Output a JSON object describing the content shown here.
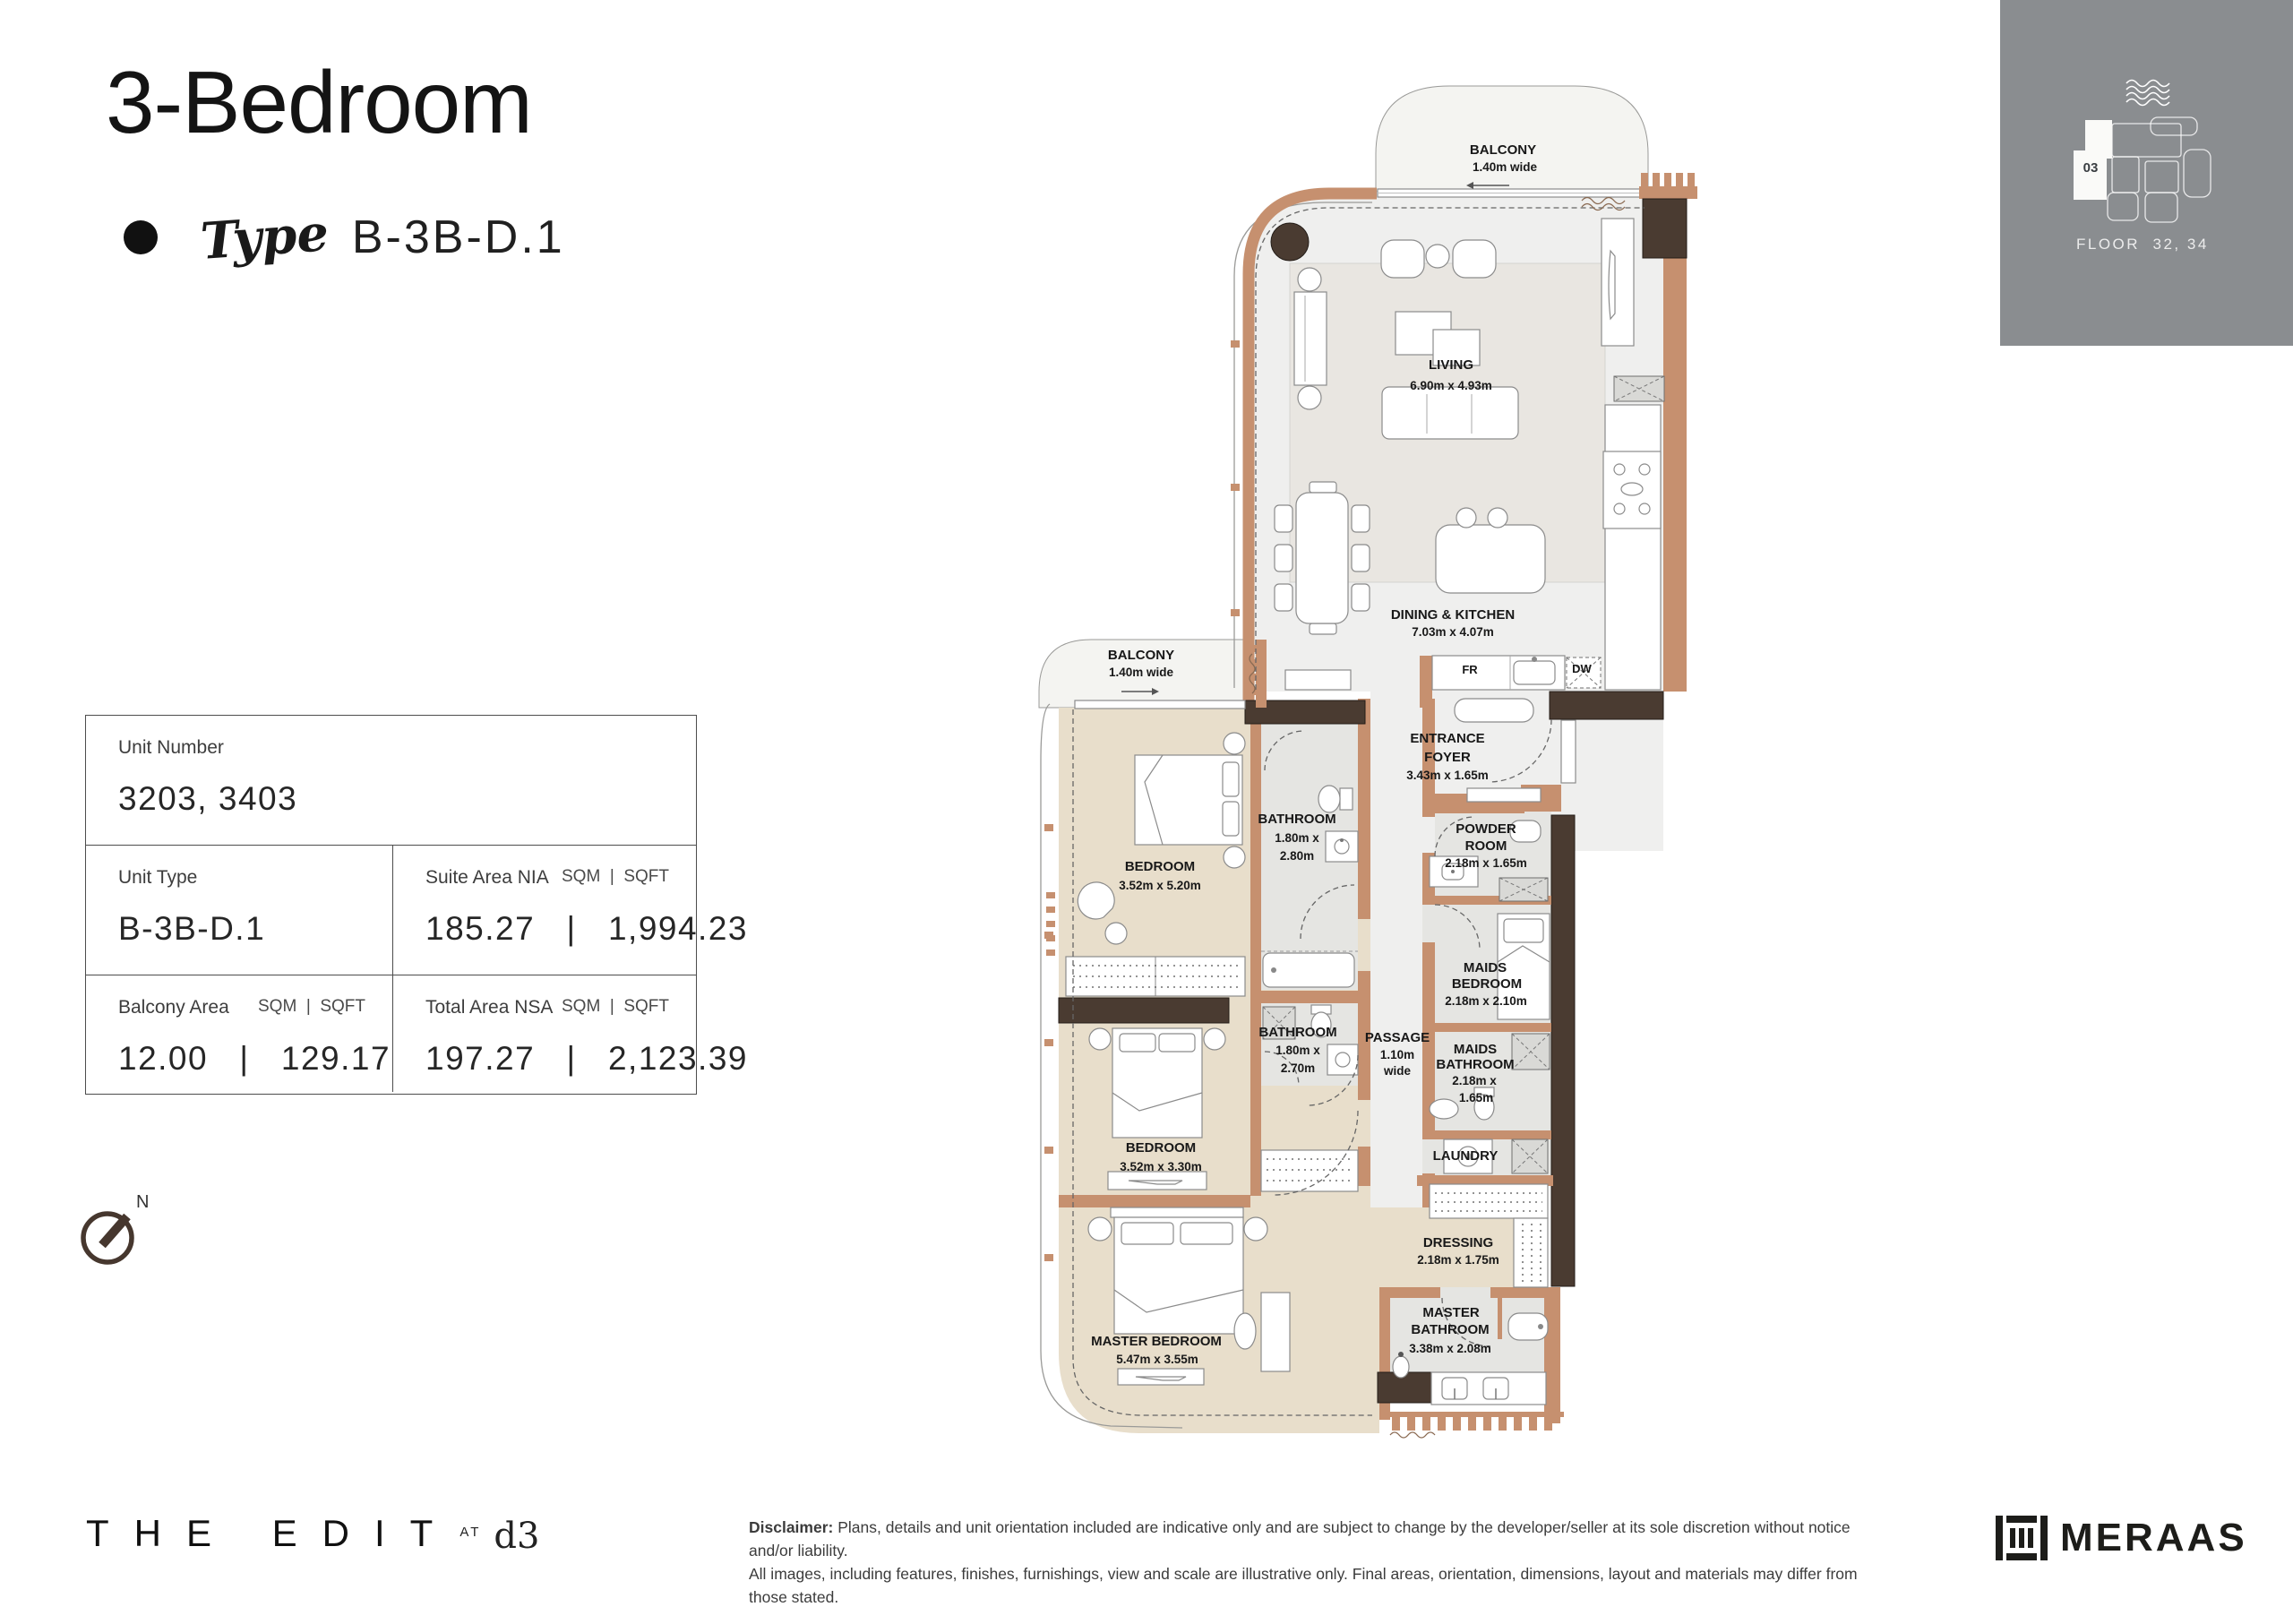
{
  "header": {
    "title": "3-Bedroom",
    "type_script": "Type",
    "type_code": "B-3B-D.1"
  },
  "floor_key": {
    "unit_number": "03",
    "floor_label": "FLOOR  32, 34"
  },
  "info_table": {
    "unit_number_label": "Unit Number",
    "unit_number_value": "3203, 3403",
    "unit_type_label": "Unit Type",
    "unit_type_value": "B-3B-D.1",
    "suite_label": "Suite Area NIA",
    "suite_units": "SQM  |  SQFT",
    "suite_value": "185.27   |   1,994.23",
    "balcony_label": "Balcony Area",
    "balcony_units": "SQM  |  SQFT",
    "balcony_value": "12.00   |   129.17",
    "total_label": "Total Area NSA",
    "total_units": "SQM  |  SQFT",
    "total_value": "197.27   |   2,123.39"
  },
  "compass": {
    "north_label": "N"
  },
  "plan": {
    "balcony_top": {
      "name": "BALCONY",
      "dim": "1.40m wide"
    },
    "balcony_left": {
      "name": "BALCONY",
      "dim": "1.40m wide"
    },
    "living": {
      "name": "LIVING",
      "dim": "6.90m x 4.93m"
    },
    "dining_kitchen": {
      "name": "DINING & KITCHEN",
      "dim": "7.03m x 4.07m"
    },
    "entrance_foyer": {
      "line1": "ENTRANCE",
      "line2": "FOYER",
      "dim": "3.43m x 1.65m"
    },
    "powder_room": {
      "line1": "POWDER",
      "line2": "ROOM",
      "dim": "2.18m x 1.65m"
    },
    "maids_bedroom": {
      "line1": "MAIDS",
      "line2": "BEDROOM",
      "dim": "2.18m x 2.10m"
    },
    "maids_bathroom": {
      "line1": "MAIDS",
      "line2": "BATHROOM",
      "dim1": "2.18m x",
      "dim2": "1.65m"
    },
    "laundry": {
      "name": "LAUNDRY"
    },
    "passage": {
      "name": "PASSAGE",
      "dim1": "1.10m",
      "dim2": "wide"
    },
    "bathroom_1": {
      "name": "BATHROOM",
      "dim1": "1.80m x",
      "dim2": "2.80m"
    },
    "bedroom_1": {
      "name": "BEDROOM",
      "dim": "3.52m x 5.20m"
    },
    "bathroom_2": {
      "name": "BATHROOM",
      "dim1": "1.80m x",
      "dim2": "2.70m"
    },
    "bedroom_2": {
      "name": "BEDROOM",
      "dim": "3.52m x 3.30m"
    },
    "master_bedroom": {
      "name": "MASTER BEDROOM",
      "dim": "5.47m x 3.55m"
    },
    "dressing": {
      "name": "DRESSING",
      "dim": "2.18m x 1.75m"
    },
    "master_bathroom": {
      "line1": "MASTER",
      "line2": "BATHROOM",
      "dim": "3.38m x 2.08m"
    },
    "fridge_label": "FR",
    "dishwasher_label": "DW"
  },
  "footer": {
    "brand": "THE EDIT",
    "at_label": "AT",
    "d3_label": "d3",
    "disclaimer_label": "Disclaimer:",
    "disclaimer_line1": "Plans, details and unit orientation included are indicative only and are subject to change by the developer/seller at its sole discretion without notice and/or liability.",
    "disclaimer_line2": "All images, including features, finishes, furnishings, view and scale are illustrative only. Final areas, orientation, dimensions, layout and materials may differ from those stated.",
    "meraas": "MERAAS"
  }
}
